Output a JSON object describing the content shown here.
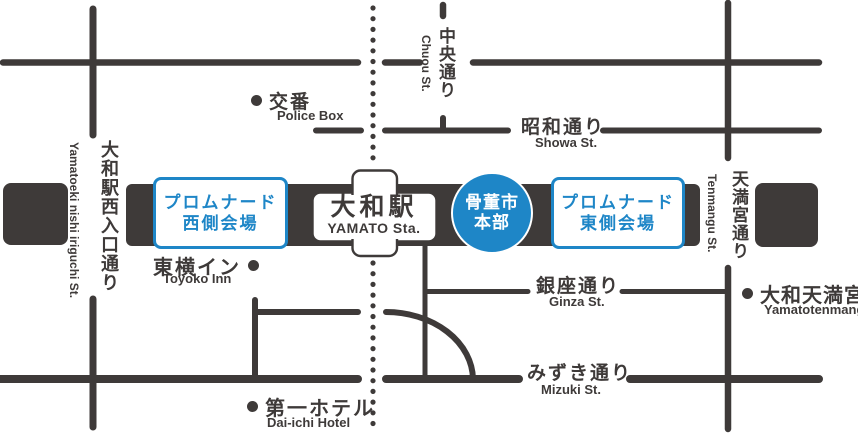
{
  "station": {
    "jp": "大和駅",
    "en": "YAMATO Sta."
  },
  "headquarters": {
    "line1": "骨董市",
    "line2": "本部"
  },
  "venues": {
    "west": {
      "line1": "プロムナード",
      "line2": "西側会場"
    },
    "east": {
      "line1": "プロムナード",
      "line2": "東側会場"
    }
  },
  "streets": {
    "chuou": {
      "jp": "中央通り",
      "en": "Chuou St."
    },
    "showa": {
      "jp": "昭和通り",
      "en": "Showa St."
    },
    "ginza": {
      "jp": "銀座通り",
      "en": "Ginza St."
    },
    "mizuki": {
      "jp": "みずき通り",
      "en": "Mizuki St."
    },
    "tenmangu": {
      "jp": "天満宮通り",
      "en": "Tenmangu St."
    },
    "nishi_iriguchi": {
      "jp": "大和駅西入口通り",
      "en": "Yamatoeki nishi iriguchi St."
    }
  },
  "landmarks": {
    "police_box": {
      "jp": "交番",
      "en": "Police Box"
    },
    "toyoko_inn": {
      "jp": "東横イン",
      "en": "Toyoko Inn"
    },
    "daiichi_hotel": {
      "jp": "第一ホテル",
      "en": "Dai-ichi Hotel"
    },
    "yamato_tenmangu": {
      "jp": "大和天満宮",
      "en": "Yamatotenmangu"
    }
  },
  "colors": {
    "road_dark": "#3e3a39",
    "accent_blue": "#1e86c7",
    "background": "#ffffff"
  }
}
